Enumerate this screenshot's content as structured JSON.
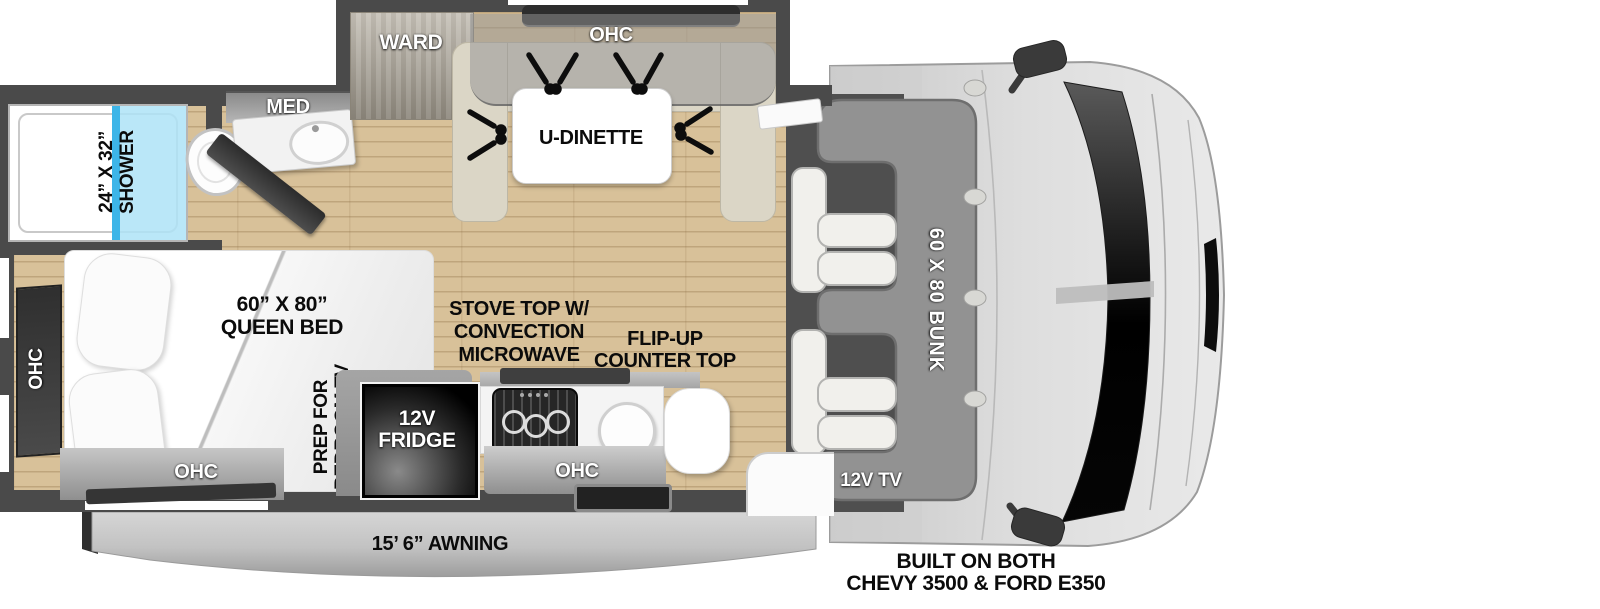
{
  "colors": {
    "wall": "#4a4a4a",
    "floor_wood": "#d8c199",
    "bench": "#dbd6c6",
    "bunk": "#929292",
    "cab_body": "#d6d6d6",
    "shower_glass": "#aee3f7",
    "shower_glass_edge": "#3db5e8",
    "cabinet_light": "#c6c6c6",
    "cabinet_dark": "#8f8f8f",
    "dark_panel": "#353535",
    "awning": "#c9c9c9"
  },
  "bathroom": {
    "shower_size": "24” X 32”",
    "shower_name": "SHOWER",
    "med_cabinet": "MED"
  },
  "dinette": {
    "wardrobe": "WARD",
    "ohc": "OHC",
    "table": "U-DINETTE"
  },
  "bedroom": {
    "bed_size": "60” X 80”",
    "bed_type": "QUEEN BED",
    "ohc_side": "OHC",
    "ohc_foot": "OHC",
    "tv_prep_1": "PREP FOR",
    "tv_prep_2": "BEDROOM TV"
  },
  "kitchen": {
    "fridge_1": "12V",
    "fridge_2": "FRIDGE",
    "stove_1": "STOVE TOP W/",
    "stove_2": "CONVECTION",
    "stove_3": "MICROWAVE",
    "flip_1": "FLIP-UP",
    "flip_2": "COUNTER TOP",
    "ohc": "OHC"
  },
  "cab": {
    "bunk": "60 X 80 BUNK",
    "tv": "12V TV"
  },
  "exterior": {
    "awning": "15’ 6” AWNING",
    "chassis_1": "BUILT ON BOTH",
    "chassis_2": "CHEVY 3500 & FORD E350"
  }
}
